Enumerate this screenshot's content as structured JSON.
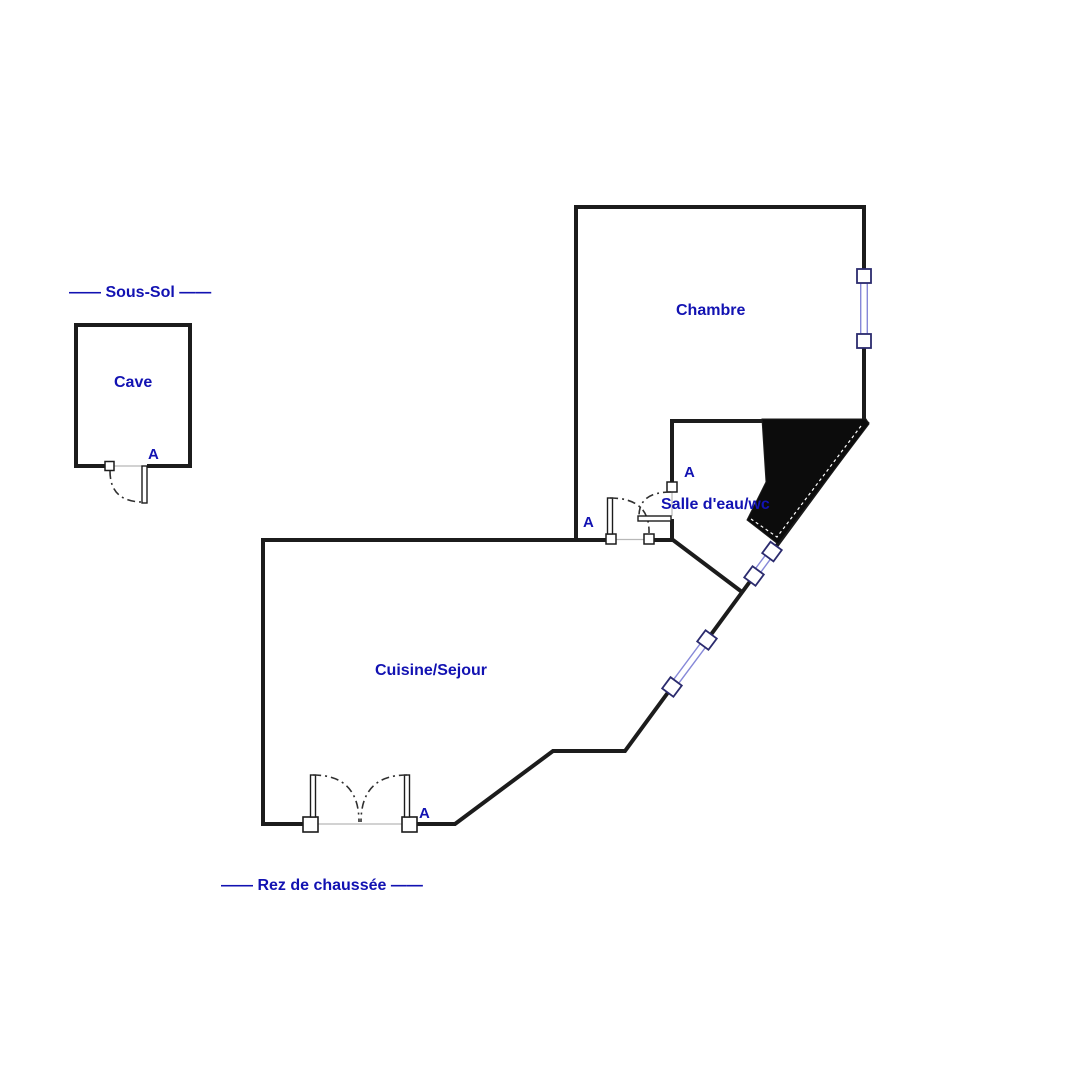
{
  "colors": {
    "label_blue": "#1212b2",
    "wall_black": "#1c1c1c",
    "window_blue": "#8688d8",
    "swing_arc_gray": "#303030",
    "threshold_gray": "#b8b8b8",
    "poche_black": "#0c0c0c"
  },
  "sous_sol": {
    "section_label": "—— Sous-Sol ——",
    "rooms": [
      {
        "label": "Cave"
      }
    ],
    "door_marker": "A"
  },
  "rez_de_chaussee": {
    "section_label": "—— Rez de chaussée ——",
    "rooms": [
      {
        "label": "Chambre"
      },
      {
        "label": "Salle d'eau/wc"
      },
      {
        "label": "Cuisine/Sejour"
      }
    ],
    "door_markers": {
      "chambre_cuisine": "A",
      "salle_eau": "A",
      "entrance": "A"
    }
  }
}
